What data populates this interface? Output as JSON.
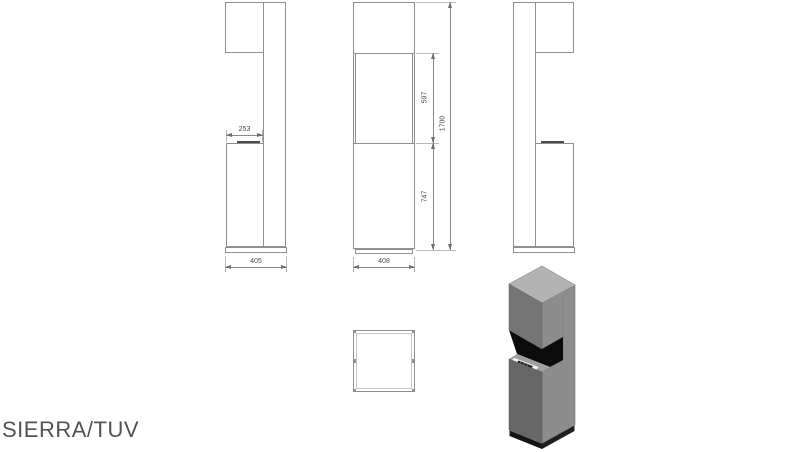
{
  "page": {
    "title": "SIERRA/TUV"
  },
  "views": {
    "left_side": {
      "dims": {
        "front_depth": "253",
        "total_depth": "405"
      }
    },
    "front": {
      "dims": {
        "width": "408",
        "middle_height": "597",
        "lower_height": "747",
        "total_height": "1700"
      }
    },
    "right_side": {},
    "top": {},
    "isometric": {}
  },
  "colors": {
    "outline": "#8f8f8f",
    "dim_text": "#4a4a4a",
    "iso_top_face": "#b3b3b3",
    "iso_left_face": "#757575",
    "iso_side_face": "#8d8d8d",
    "iso_recess": "#0c0c0c",
    "iso_top_band": "#a0a0a0",
    "iso_lower_left_face": "#676767",
    "iso_plinth_left": "#151515",
    "iso_plinth_right": "#1f1f1f",
    "iso_burner_plate": "#f4f4f4",
    "iso_burner_slot": "#1b1b1b"
  }
}
